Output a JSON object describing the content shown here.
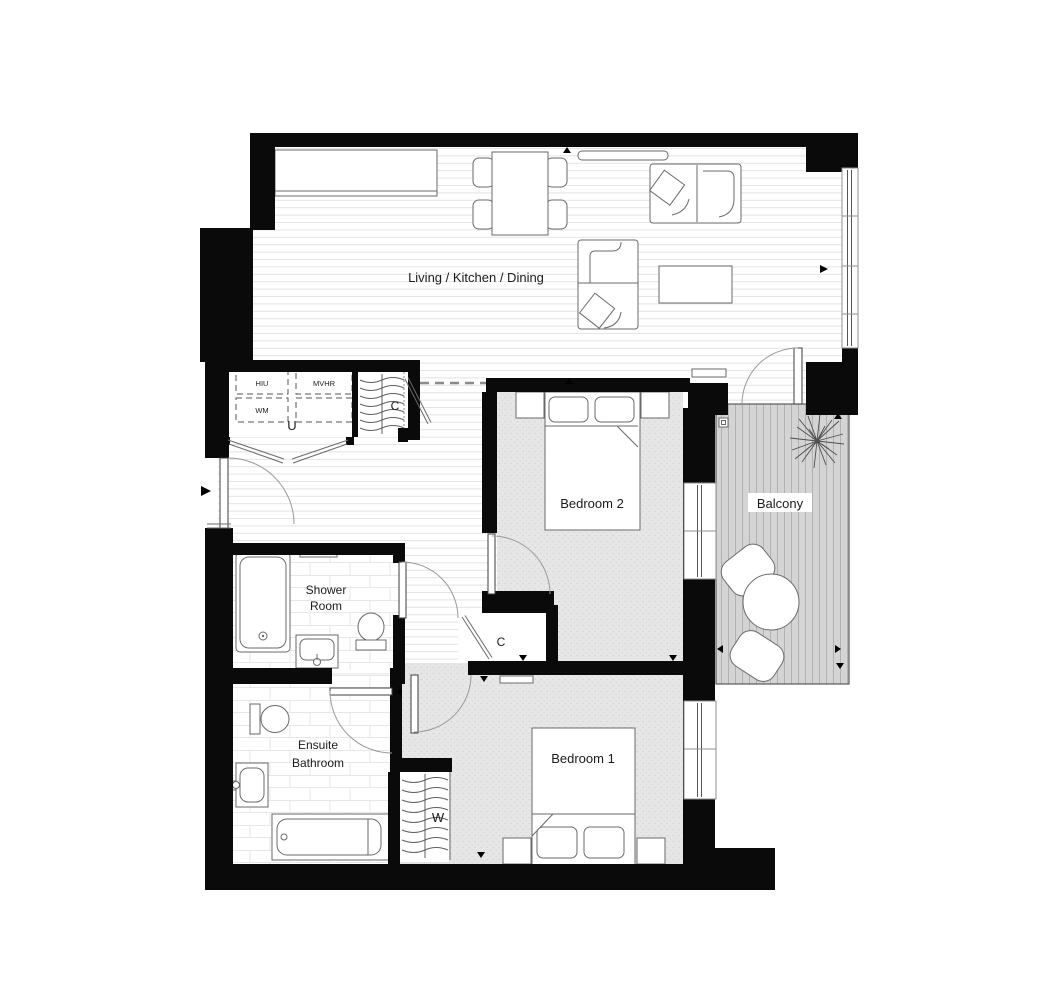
{
  "plan_title": "Apartment floor plan",
  "rooms": {
    "living": "Living / Kitchen / Dining",
    "bedroom_2": "Bedroom 2",
    "bedroom_1": "Bedroom 1",
    "balcony": "Balcony",
    "shower_room_line_1": "Shower",
    "shower_room_line_2": "Room",
    "ensuite_line_1": "Ensuite",
    "ensuite_line_2": "Bathroom"
  },
  "closets": {
    "utility": "U",
    "utility_cupboard": "C",
    "hall_cupboard": "C",
    "wardrobe": "W"
  },
  "appliances": {
    "hiu": "HIU",
    "mvhr": "MVHR",
    "wm": "WM"
  },
  "colors": {
    "wall": "#0a0a0a",
    "bedroom_floor": "#e6e6e6",
    "balcony_deck": "#d4d4d4",
    "floorboard_line": "#e3e3e3",
    "furniture_line": "#6a6a6a"
  }
}
